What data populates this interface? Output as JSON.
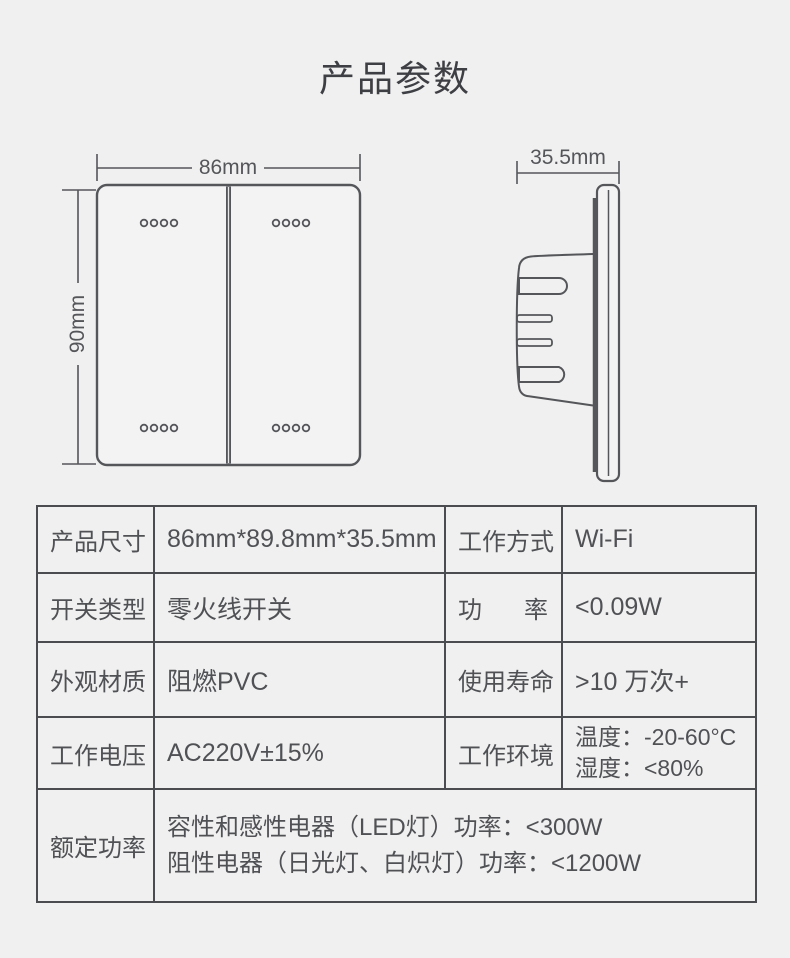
{
  "title": "产品参数",
  "colors": {
    "background": "#f0f0f0",
    "drawing_line": "#55565a",
    "table_border": "#4b4c4f",
    "text": "#505155"
  },
  "front_view": {
    "width_label": "86mm",
    "height_label": "90mm"
  },
  "side_view": {
    "depth_label": "35.5mm"
  },
  "spec_table": {
    "rows": [
      {
        "label1": "产品尺寸",
        "value1": "86mm*89.8mm*35.5mm",
        "label2": "工作方式",
        "value2": "Wi-Fi"
      },
      {
        "label1": "开关类型",
        "value1": "零火线开关",
        "label2": "功率",
        "value2": "<0.09W"
      },
      {
        "label1": "外观材质",
        "value1": "阻燃PVC",
        "label2": "使用寿命",
        "value2": ">10 万次+"
      },
      {
        "label1": "工作电压",
        "value1": "AC220V±15%",
        "label2": "工作环境",
        "value2_line1": "温度：-20-60°C",
        "value2_line2": "湿度：<80%"
      },
      {
        "label1": "额定功率",
        "value_line1": "容性和感性电器（LED灯）功率：<300W",
        "value_line2": "阻性电器（日光灯、白炽灯）功率：<1200W"
      }
    ]
  }
}
